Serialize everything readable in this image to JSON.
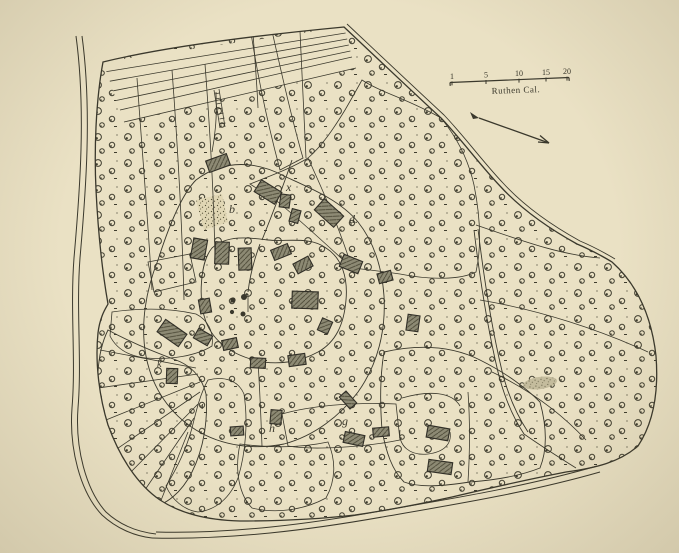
{
  "map": {
    "scale_bar": {
      "label": "Ruthen Cal.",
      "ticks": [
        {
          "value": "1"
        },
        {
          "value": "5"
        },
        {
          "value": "10"
        },
        {
          "value": "15"
        },
        {
          "value": "20"
        }
      ]
    },
    "north_arrow": {
      "direction": "southeast"
    },
    "labels": [
      {
        "text": "x",
        "x": 286,
        "y": 191,
        "size": "normal"
      },
      {
        "text": "d.",
        "x": 349,
        "y": 223,
        "size": "normal"
      },
      {
        "text": "b",
        "x": 229,
        "y": 213,
        "size": "normal"
      },
      {
        "text": "k",
        "x": 157,
        "y": 367,
        "size": "small"
      },
      {
        "text": "i",
        "x": 201,
        "y": 409,
        "size": "small"
      },
      {
        "text": "h",
        "x": 269,
        "y": 432,
        "size": "normal"
      },
      {
        "text": "g",
        "x": 342,
        "y": 425,
        "size": "normal"
      }
    ],
    "buildings": [
      {
        "x": 218,
        "y": 163,
        "w": 22,
        "h": 12,
        "r": -20
      },
      {
        "x": 268,
        "y": 192,
        "w": 24,
        "h": 14,
        "r": 32
      },
      {
        "x": 285,
        "y": 201,
        "w": 10,
        "h": 13,
        "r": 8
      },
      {
        "x": 295,
        "y": 216,
        "w": 9,
        "h": 13,
        "r": 15
      },
      {
        "x": 329,
        "y": 213,
        "w": 26,
        "h": 15,
        "r": 42
      },
      {
        "x": 199,
        "y": 249,
        "w": 14,
        "h": 20,
        "r": 10
      },
      {
        "x": 222,
        "y": 253,
        "w": 14,
        "h": 22,
        "r": 2
      },
      {
        "x": 245,
        "y": 259,
        "w": 13,
        "h": 22,
        "r": -2
      },
      {
        "x": 281,
        "y": 252,
        "w": 18,
        "h": 11,
        "r": -22
      },
      {
        "x": 303,
        "y": 265,
        "w": 17,
        "h": 11,
        "r": -28
      },
      {
        "x": 351,
        "y": 264,
        "w": 20,
        "h": 13,
        "r": 22
      },
      {
        "x": 385,
        "y": 277,
        "w": 14,
        "h": 10,
        "r": -15
      },
      {
        "x": 305,
        "y": 300,
        "w": 26,
        "h": 17,
        "r": 2
      },
      {
        "x": 325,
        "y": 326,
        "w": 11,
        "h": 13,
        "r": 24
      },
      {
        "x": 413,
        "y": 323,
        "w": 12,
        "h": 16,
        "r": 8
      },
      {
        "x": 205,
        "y": 306,
        "w": 11,
        "h": 14,
        "r": -10
      },
      {
        "x": 172,
        "y": 333,
        "w": 26,
        "h": 15,
        "r": 35
      },
      {
        "x": 203,
        "y": 337,
        "w": 16,
        "h": 11,
        "r": 30
      },
      {
        "x": 230,
        "y": 344,
        "w": 15,
        "h": 10,
        "r": -12
      },
      {
        "x": 172,
        "y": 376,
        "w": 11,
        "h": 15,
        "r": 2
      },
      {
        "x": 258,
        "y": 363,
        "w": 15,
        "h": 10,
        "r": 3
      },
      {
        "x": 297,
        "y": 360,
        "w": 17,
        "h": 11,
        "r": -8
      },
      {
        "x": 237,
        "y": 431,
        "w": 13,
        "h": 9,
        "r": -4
      },
      {
        "x": 276,
        "y": 417,
        "w": 11,
        "h": 14,
        "r": 5
      },
      {
        "x": 348,
        "y": 400,
        "w": 16,
        "h": 9,
        "r": 48
      },
      {
        "x": 354,
        "y": 439,
        "w": 20,
        "h": 11,
        "r": 12
      },
      {
        "x": 381,
        "y": 432,
        "w": 16,
        "h": 9,
        "r": -5
      },
      {
        "x": 438,
        "y": 433,
        "w": 22,
        "h": 12,
        "r": 10
      },
      {
        "x": 440,
        "y": 467,
        "w": 24,
        "h": 12,
        "r": 8
      }
    ],
    "colors": {
      "paper": "#eae1c4",
      "ink": "#3a382c",
      "building": "#8d8a74"
    }
  }
}
